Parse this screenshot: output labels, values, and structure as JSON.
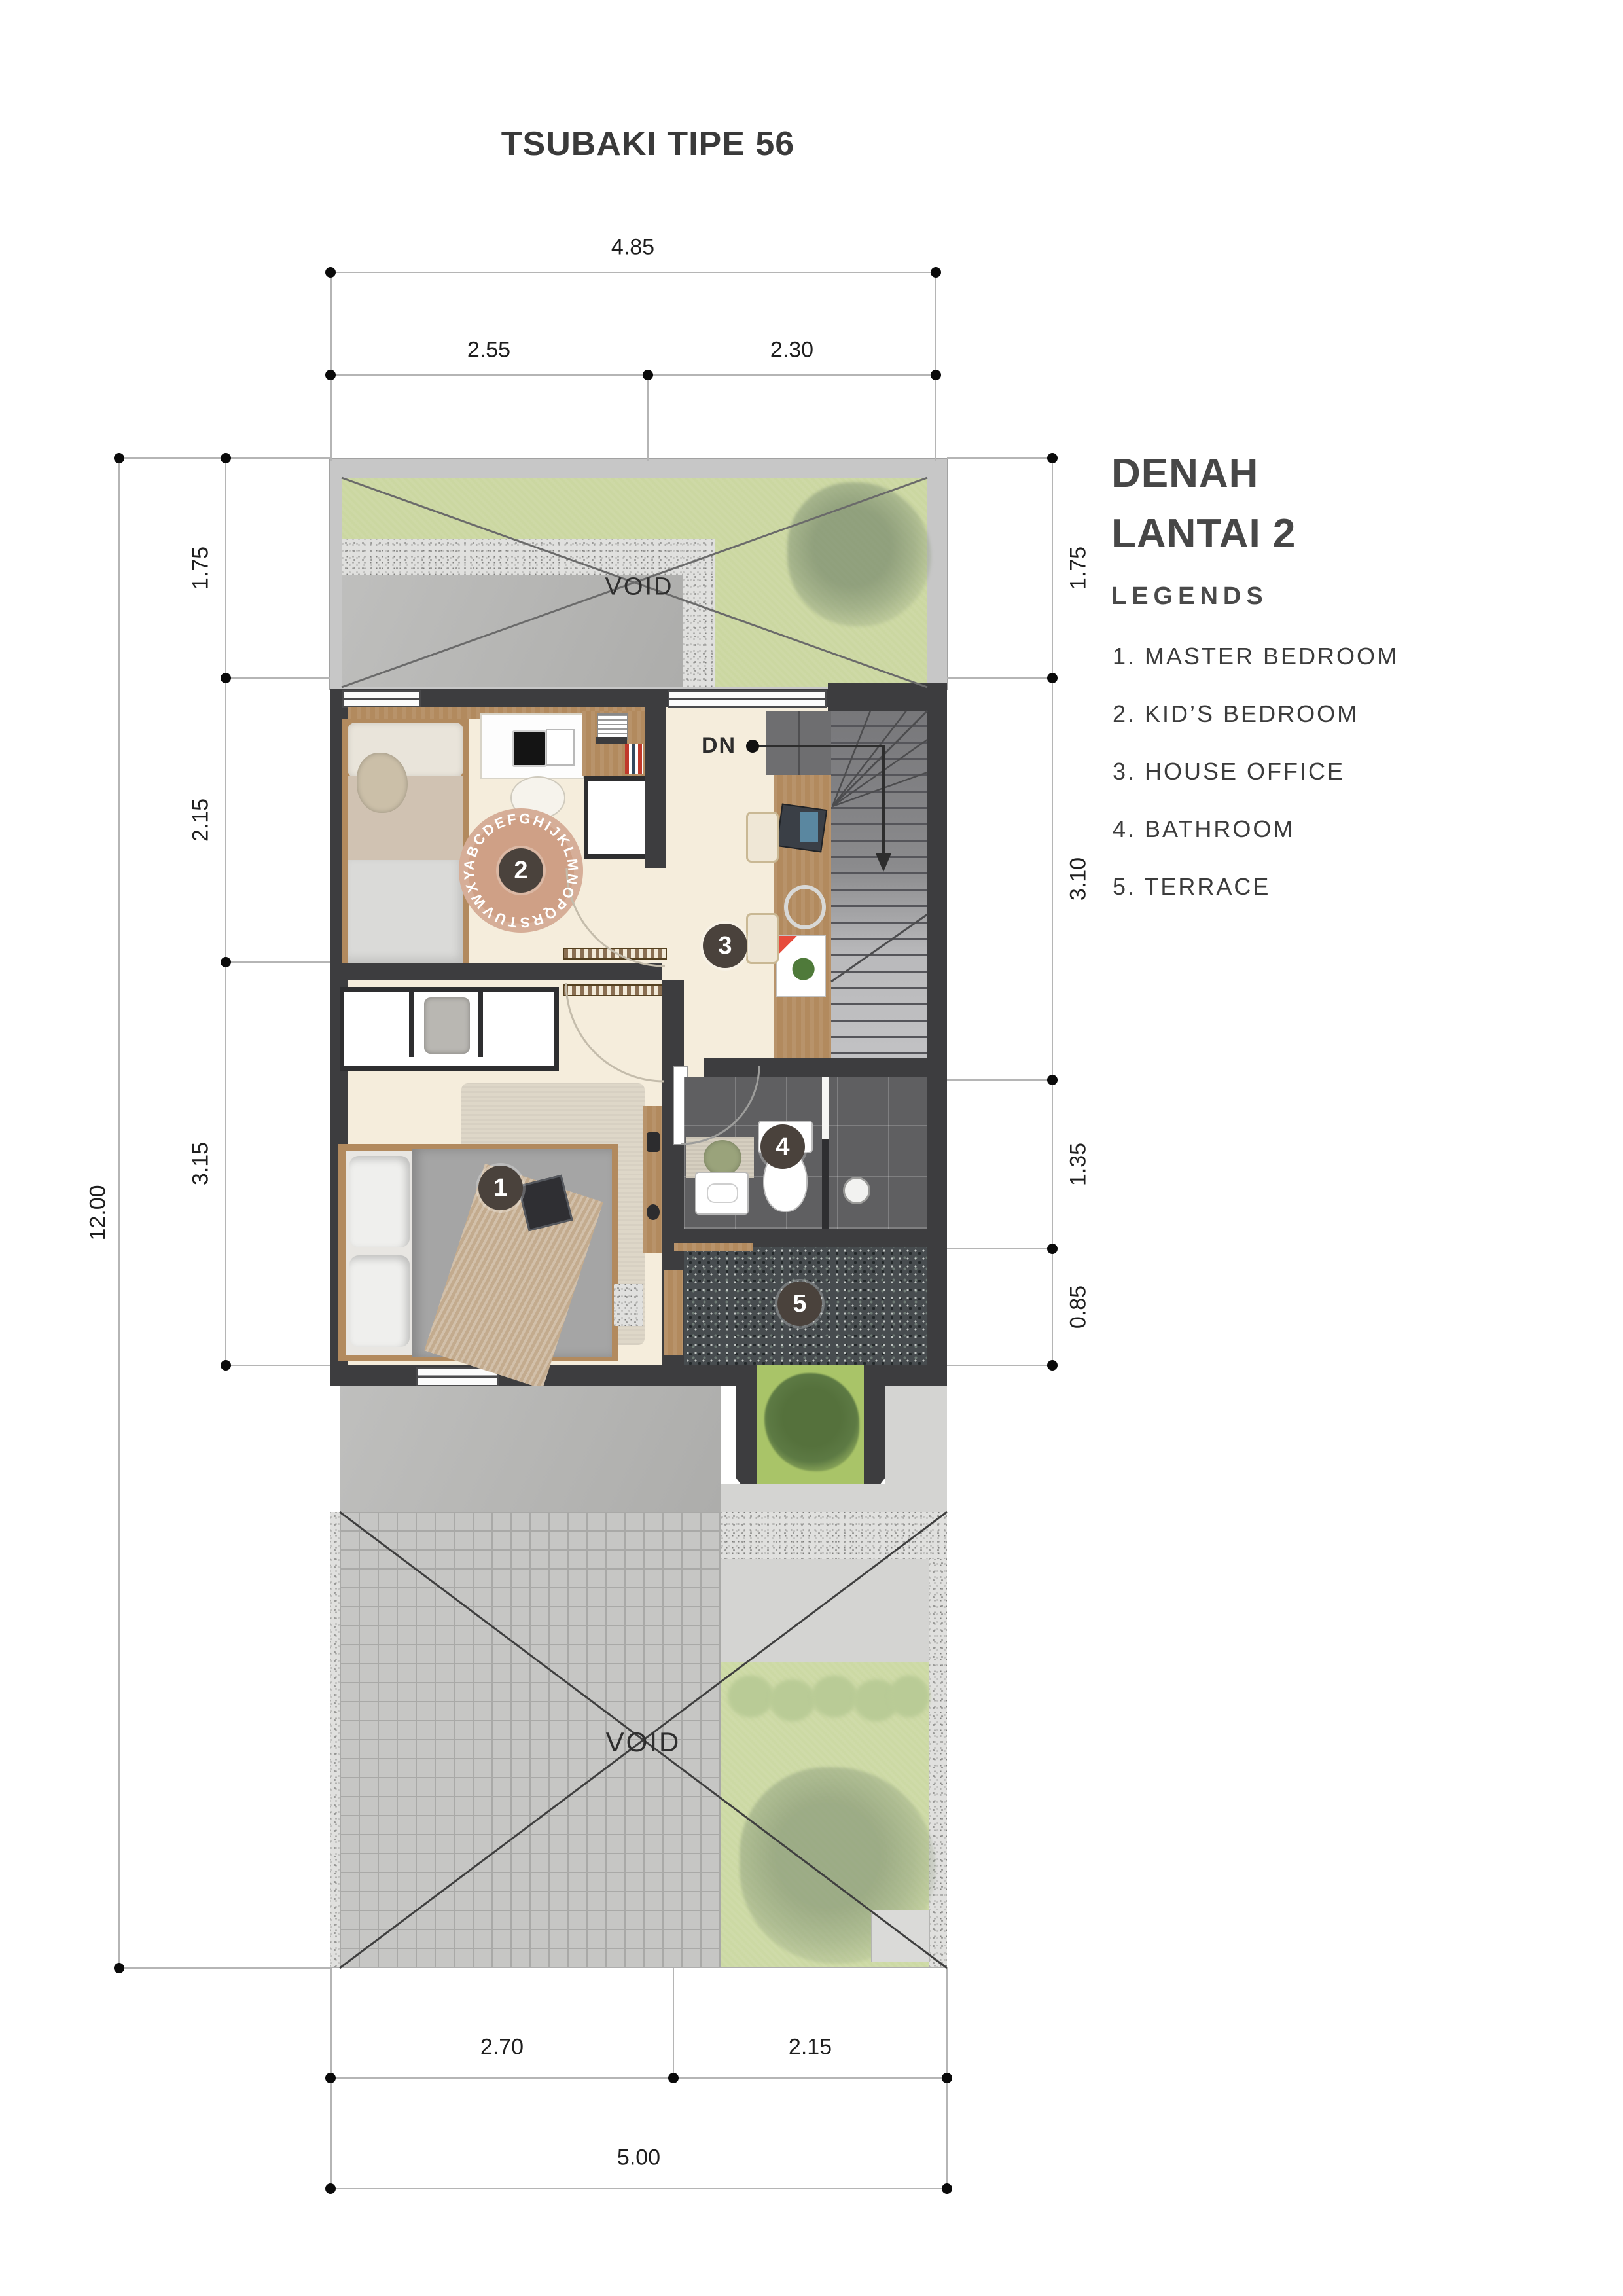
{
  "title": "TSUBAKI TIPE 56",
  "legend": {
    "heading_line1": "DENAH",
    "heading_line2": "LANTAI 2",
    "subheading": "LEGENDS",
    "items": [
      "1. MASTER BEDROOM",
      "2. KID’S BEDROOM",
      "3. HOUSE OFFICE",
      "4. BATHROOM",
      "5. TERRACE"
    ]
  },
  "plan": {
    "void_top": "VOID",
    "void_bottom": "VOID",
    "stairs_label": "DN",
    "rug_letters": "ABCDEFGHIJKLMNOPQRSTUVWXYZ",
    "markers": [
      "1",
      "2",
      "3",
      "4",
      "5"
    ]
  },
  "dims": {
    "top_total": "4.85",
    "top_left": "2.55",
    "top_right": "2.30",
    "bottom_left": "2.70",
    "bottom_right": "2.15",
    "bottom_total": "5.00",
    "left_total": "12.00",
    "left_seg1": "1.75",
    "left_seg2": "2.15",
    "left_seg3": "3.15",
    "right_seg1": "1.75",
    "right_seg2": "3.10",
    "right_seg3": "1.35",
    "right_seg4": "0.85"
  }
}
